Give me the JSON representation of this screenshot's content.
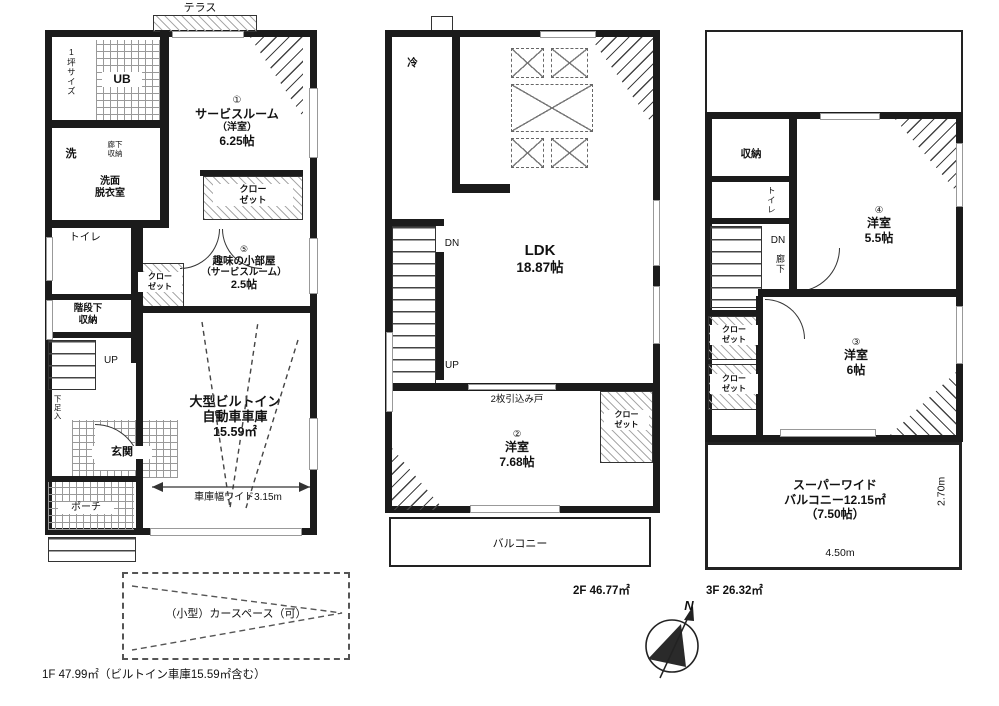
{
  "colors": {
    "wall": "#1b1b1b",
    "line": "#444",
    "text": "#111"
  },
  "compass": {
    "n": "N"
  },
  "f1": {
    "terrace": "テラス",
    "tub": "1坪サイズ",
    "ub": "UB",
    "laundry": "洗",
    "hall_storage": "廊下\n収納",
    "washroom": "洗面\n脱衣室",
    "room1": {
      "no": "①",
      "name": "サービスルーム",
      "sub": "（洋室）",
      "size": "6.25帖"
    },
    "closet1": "クロー\nゼット",
    "toilet": "トイレ",
    "understair": "階段下\n収納",
    "closet2": "クロー\nゼット",
    "room5": {
      "no": "⑤",
      "name": "趣味の小部屋",
      "sub": "（サービスルーム）",
      "size": "2.5帖"
    },
    "up": "UP",
    "shoes": "下足入",
    "entrance": "玄関",
    "porch": "ポーチ",
    "garage": {
      "name1": "大型ビルトイン",
      "name2": "自動車車庫",
      "size": "15.59㎡"
    },
    "garage_width": "車庫幅ワイド3.15m",
    "carspace": "（小型）カースペース（可）",
    "area": "1F 47.99㎡（ビルトイン車庫15.59㎡含む）"
  },
  "f2": {
    "fridge": "冷",
    "dn": "DN",
    "up": "UP",
    "ldk": {
      "name": "LDK",
      "size": "18.87帖"
    },
    "sliding_door": "2枚引込み戸",
    "room2": {
      "no": "②",
      "name": "洋室",
      "size": "7.68帖"
    },
    "closet": "クロー\nゼット",
    "balcony": "バルコニー",
    "area": "2F 46.77㎡"
  },
  "f3": {
    "storage": "収納",
    "toilet": "トイレ",
    "dn": "DN",
    "hall": "廊下",
    "closet1": "クロー\nゼット",
    "closet2": "クロー\nゼット",
    "room4": {
      "no": "④",
      "name": "洋室",
      "size": "5.5帖"
    },
    "room3": {
      "no": "③",
      "name": "洋室",
      "size": "6帖"
    },
    "balcony": {
      "line1": "スーパーワイド",
      "line2": "バルコニー12.15㎡",
      "line3": "（7.50帖）"
    },
    "dim_w": "4.50m",
    "dim_h": "2.70m",
    "area": "3F 26.32㎡"
  }
}
